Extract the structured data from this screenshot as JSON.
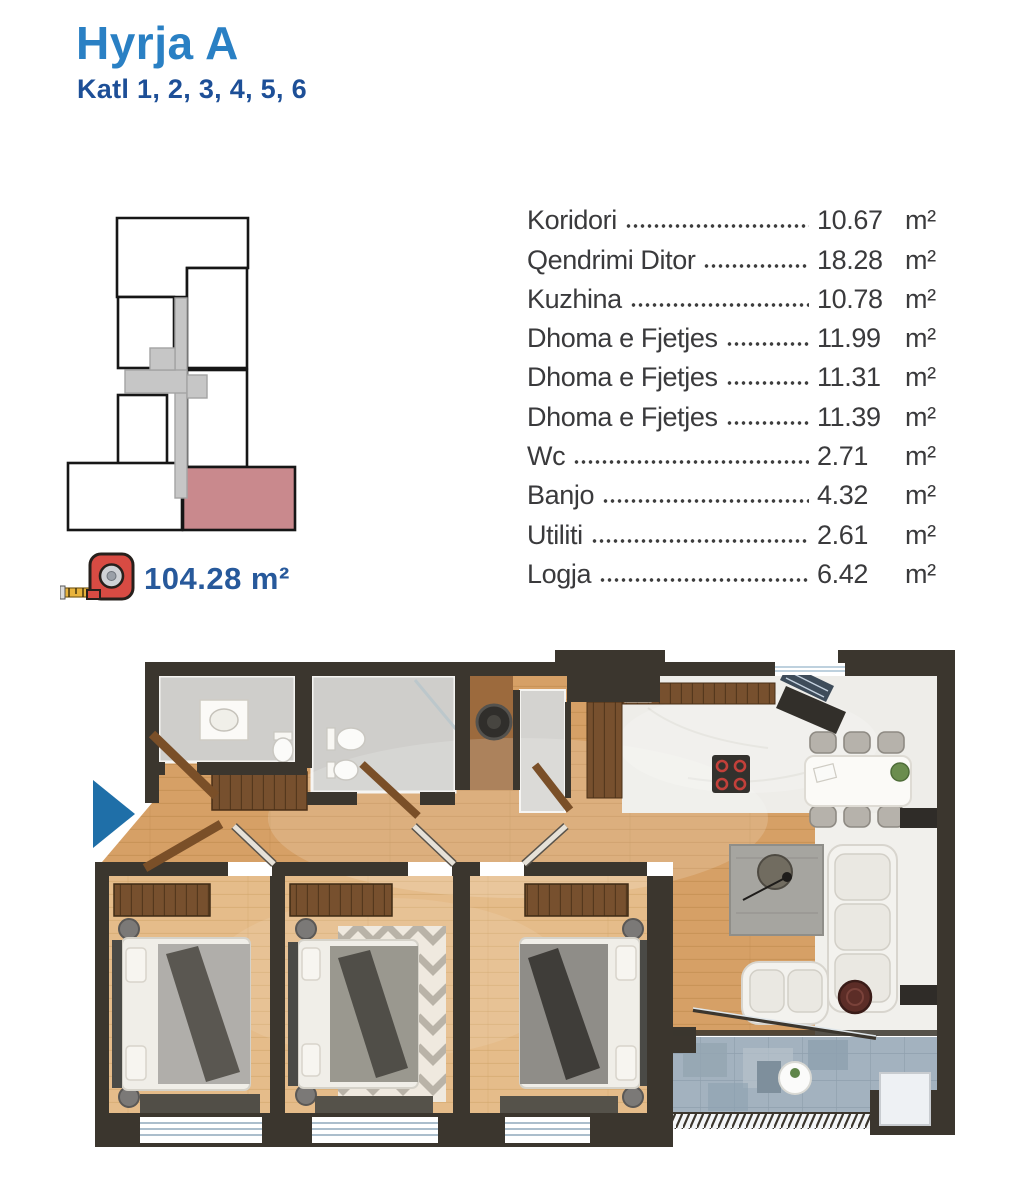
{
  "header": {
    "title": "Hyrja A",
    "subtitle": "Katl 1, 2, 3, 4, 5, 6"
  },
  "unit_summary": {
    "total_area": "104.28 m²"
  },
  "rooms": [
    {
      "name": "Koridori",
      "area": "10.67",
      "unit": "m²"
    },
    {
      "name": "Qendrimi Ditor",
      "area": "18.28",
      "unit": "m²"
    },
    {
      "name": "Kuzhina",
      "area": "10.78",
      "unit": "m²"
    },
    {
      "name": "Dhoma e Fjetjes",
      "area": "11.99",
      "unit": "m²"
    },
    {
      "name": "Dhoma e Fjetjes",
      "area": "11.31",
      "unit": "m²"
    },
    {
      "name": "Dhoma e Fjetjes",
      "area": "11.39",
      "unit": "m²"
    },
    {
      "name": "Wc",
      "area": "2.71",
      "unit": "m²"
    },
    {
      "name": "Banjo",
      "area": "4.32",
      "unit": "m²"
    },
    {
      "name": "Utiliti",
      "area": "2.61",
      "unit": "m²"
    },
    {
      "name": "Logja",
      "area": "6.42",
      "unit": "m²"
    }
  ],
  "icons": {
    "tape_measure": "tape-measure-icon",
    "entrance_arrow": "entrance-arrow"
  },
  "key_plan": {
    "highlight_color": "#c9898d",
    "core_color": "#c6c6c6",
    "outline_color": "#161616"
  },
  "floor_plan": {
    "entrance_marker_color": "#1f6fa8",
    "wall_color": "#3b362e",
    "wood_color": "#d6a066",
    "bedroom_wood_color": "#e5bc8a",
    "tile_color": "#cfcecb",
    "balcony_color": "#a3b2bf"
  }
}
